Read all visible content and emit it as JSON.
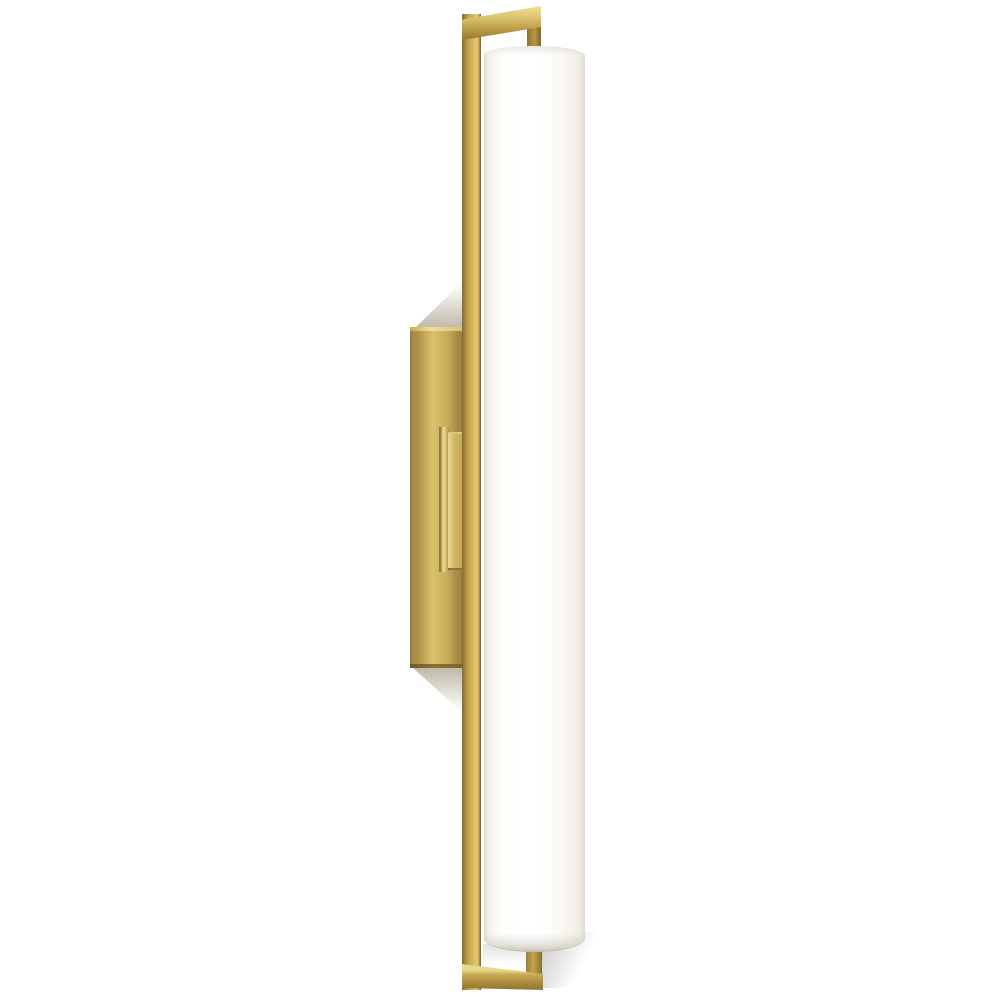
{
  "image": {
    "description": "Product photograph of a tall vertical wall sconce on a plain white background: an open rectangular natural-brass frame holding a white cylindrical glass diffuser, with a brass wall backplate and stepped mounting arm at mid-height",
    "subject": "brass-linear-cylinder-wall-sconce",
    "background": "#ffffff"
  },
  "parts": {
    "wall_sconce": "wall sconce fixture",
    "frame_vertical_bar": "frame long vertical bar",
    "frame_top_bar": "frame top horizontal bar",
    "frame_bottom_bar": "frame bottom horizontal bar",
    "top_connector_stem": "top connector stem",
    "bottom_connector_stem": "bottom connector stem",
    "glass_diffuser": "white cylindrical glass diffuser",
    "glass_top_rim": "diffuser top rim",
    "glass_bottom_rim": "diffuser bottom rim",
    "wall_backplate": "brass wall backplate",
    "backplate_top_edge": "backplate top edge highlight",
    "backplate_bottom_edge": "backplate bottom edge shadow",
    "mounting_arm_step": "mounting arm step",
    "mounting_arm_block": "mounting arm block",
    "shadow_above_backplate": "soft shadow above backplate",
    "shadow_below_backplate": "soft shadow below backplate",
    "glass_gap_shadow": "soft shadow under glass left",
    "glass_bottom_shadow": "soft shadow under glass right"
  },
  "colors": {
    "background": "#ffffff",
    "brass_highlight": "#ecdf96",
    "brass_light": "#d8c26c",
    "brass_mid": "#c8ac5c",
    "brass_base": "#b0914a",
    "brass_dark": "#96793b",
    "brass_deep": "#6b5827",
    "glass_white": "#ffffff",
    "glass_warm": "#f7f3ea",
    "glass_edge": "#dcd8cc",
    "glass_rim": "#cec9bb",
    "shadow_brass": "rgba(115,100,62,0.45)",
    "shadow_gray": "rgba(95,92,82,0.4)"
  }
}
